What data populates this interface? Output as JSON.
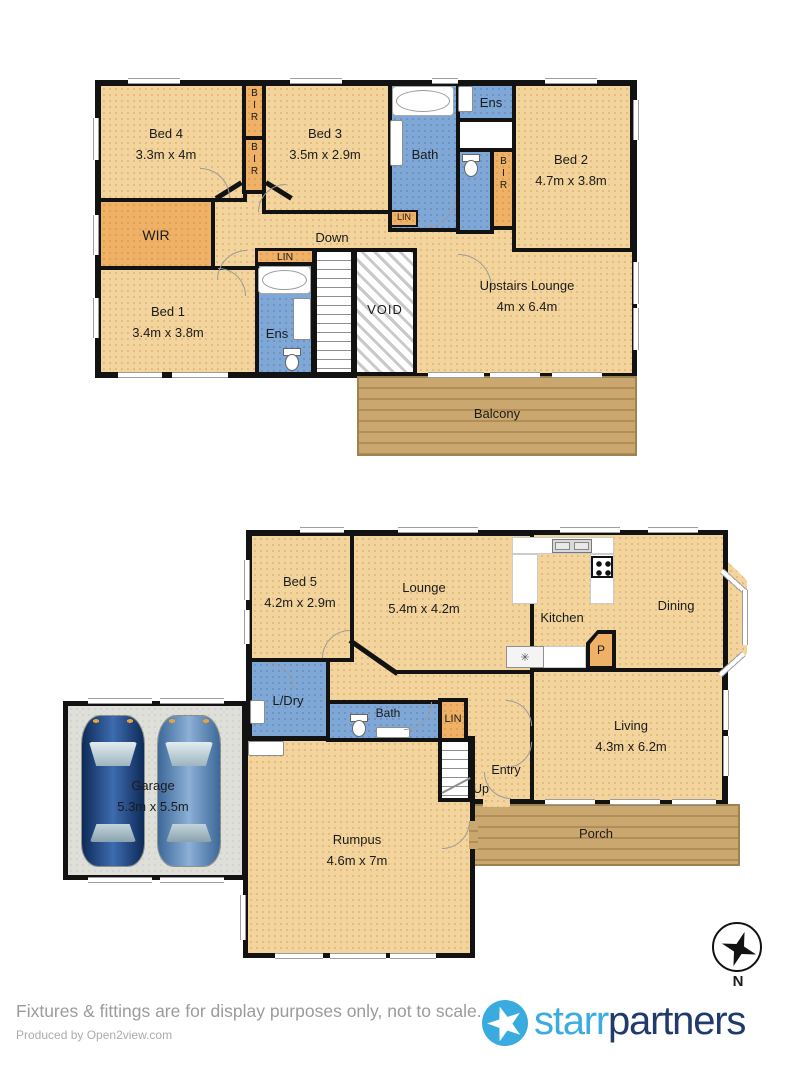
{
  "palette": {
    "room_tan": "#f3d49c",
    "wet_blue": "#7fa8d7",
    "closet_orange": "#eeb165",
    "wood": "#c9a76f",
    "garage_gray": "#dedfd8",
    "wall": "#121212",
    "brand_light_blue": "#3bacdf",
    "brand_navy": "#203a6c"
  },
  "upper": {
    "bed4": {
      "label": "Bed 4",
      "dims": "3.3m x 4m"
    },
    "bed3": {
      "label": "Bed 3",
      "dims": "3.5m x 2.9m"
    },
    "bed2": {
      "label": "Bed 2",
      "dims": "4.7m x 3.8m"
    },
    "bed1": {
      "label": "Bed 1",
      "dims": "3.4m x 3.8m"
    },
    "bath": {
      "label": "Bath"
    },
    "ens_top": {
      "label": "Ens"
    },
    "ens_lower": {
      "label": "Ens"
    },
    "wir": {
      "label": "WIR"
    },
    "bir_a": {
      "label": "BIR"
    },
    "bir_b": {
      "label": "BIR"
    },
    "bir_c": {
      "label": "BIR"
    },
    "lin_bath": {
      "label": "LIN"
    },
    "lin_lower": {
      "label": "LIN"
    },
    "down": {
      "label": "Down"
    },
    "void": {
      "label": "VOID"
    },
    "lounge": {
      "label": "Upstairs Lounge",
      "dims": "4m x 6.4m"
    },
    "balcony": {
      "label": "Balcony"
    }
  },
  "ground": {
    "bed5": {
      "label": "Bed 5",
      "dims": "4.2m x 2.9m"
    },
    "lounge": {
      "label": "Lounge",
      "dims": "5.4m x 4.2m"
    },
    "kitchen": {
      "label": "Kitchen"
    },
    "dining": {
      "label": "Dining"
    },
    "pantry": {
      "label": "P"
    },
    "ldry": {
      "label": "L/Dry"
    },
    "bath": {
      "label": "Bath"
    },
    "lin": {
      "label": "LIN"
    },
    "living": {
      "label": "Living",
      "dims": "4.3m x 6.2m"
    },
    "entry": {
      "label": "Entry"
    },
    "up": {
      "label": "Up"
    },
    "rumpus": {
      "label": "Rumpus",
      "dims": "4.6m x 7m"
    },
    "garage": {
      "label": "Garage",
      "dims": "5.3m x 5.5m"
    },
    "porch": {
      "label": "Porch"
    },
    "fridge_icon": "✳"
  },
  "compass": {
    "label": "N"
  },
  "footer": {
    "disclaimer": "Fixtures & fittings are for display purposes only, not to scale.",
    "produced_by": "Produced by Open2view.com",
    "brand_first": "starr",
    "brand_second": "partners"
  }
}
